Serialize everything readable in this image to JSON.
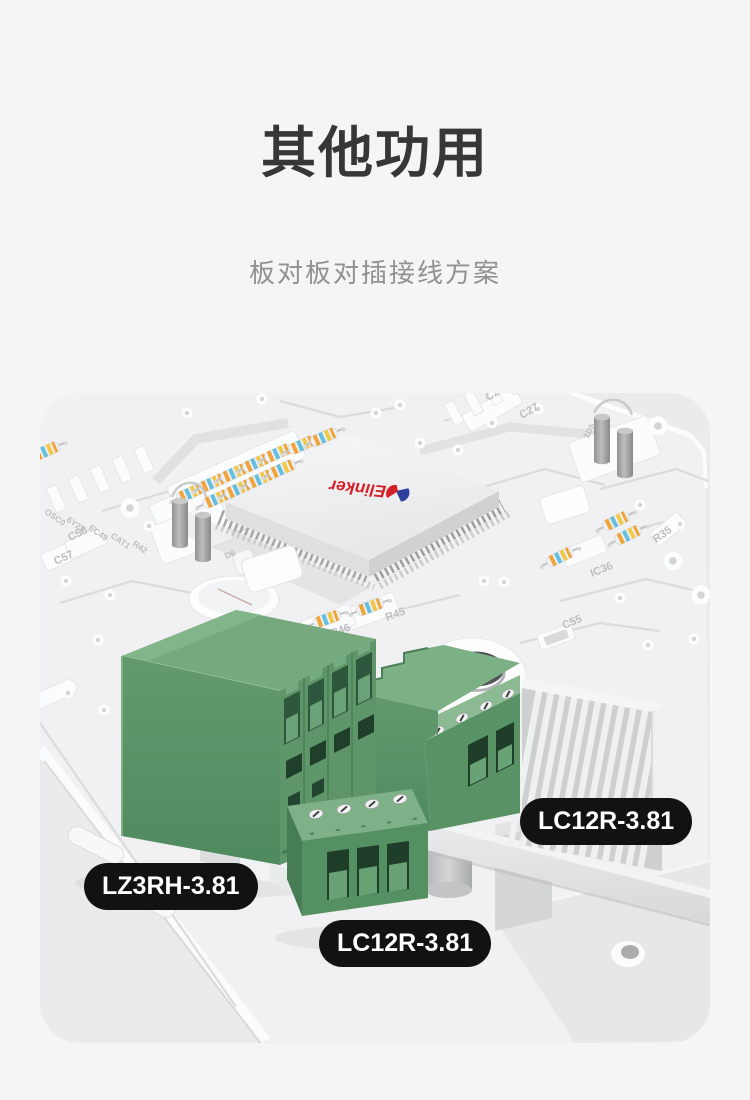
{
  "page": {
    "background": "#f5f5f6"
  },
  "header": {
    "title": "其他功用",
    "subtitle": "板对板对插接线方案",
    "title_color": "#373737",
    "subtitle_color": "#8f9193"
  },
  "figure": {
    "card_background": "#ebebed",
    "pcb_color": "#f1f1f3",
    "connector_green": "#5f9768",
    "label_bg": "#121212",
    "label_text_color": "#ffffff",
    "chip": {
      "brand": "Elinker",
      "brand_color": "#d5222a",
      "logo_blue": "#2e3f9f"
    },
    "labels": [
      {
        "text": "LZ3RH-3.81"
      },
      {
        "text": "LC12R-3.81"
      },
      {
        "text": "LC12R-3.81"
      }
    ],
    "silkscreen": [
      "R45",
      "R46",
      "C55",
      "R35",
      "IC36",
      "C57",
      "C58",
      "C27",
      "C26",
      "OSC0",
      "6Y23",
      "EC49",
      "CAT1",
      "R42",
      "1D5",
      "D6"
    ]
  }
}
